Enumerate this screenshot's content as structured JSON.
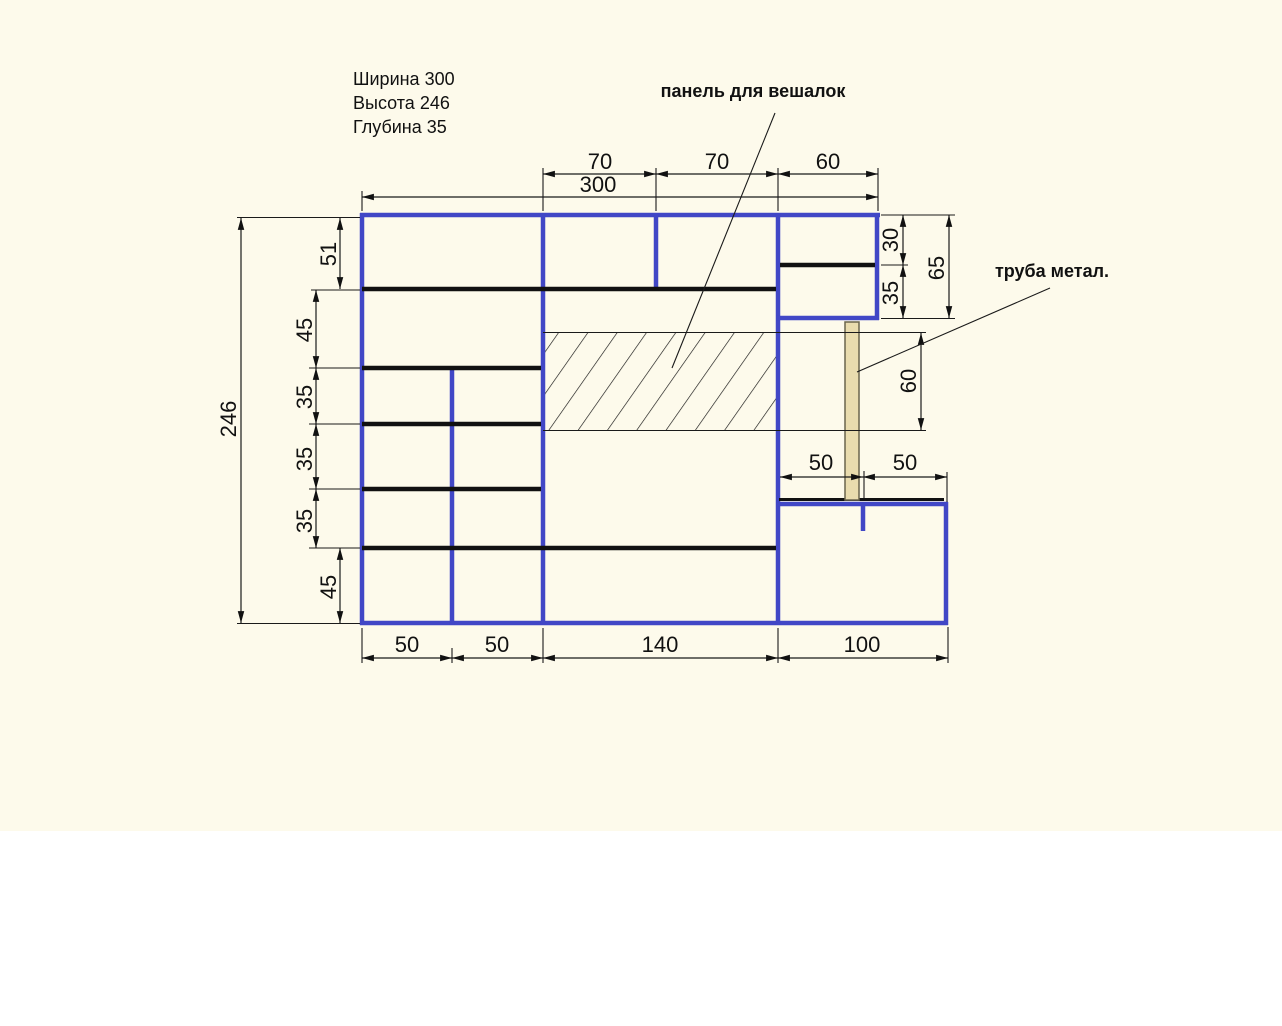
{
  "info_block": {
    "line1": "Ширина 300",
    "line2": "Высота 246",
    "line3": "Глубина 35"
  },
  "labels": {
    "panel": "панель для вешалок",
    "pipe": "труба метал."
  },
  "dims": {
    "top": {
      "d70a": "70",
      "d70b": "70",
      "d60": "60",
      "overall": "300"
    },
    "left": {
      "overall": "246",
      "r51": "51",
      "r45a": "45",
      "r35a": "35",
      "r35b": "35",
      "r35c": "35",
      "r45b": "45"
    },
    "right": {
      "d30": "30",
      "d35": "35",
      "d65": "65",
      "pipe60": "60"
    },
    "mid": {
      "d50a": "50",
      "d50b": "50"
    },
    "bottom": {
      "c50a": "50",
      "c50b": "50",
      "c140": "140",
      "c100": "100"
    }
  },
  "colors": {
    "background": "#fdfaeb",
    "paper_lower": "#ffffff",
    "structure_blue": "#4147c6",
    "line_black": "#1a1a1a",
    "pipe_fill": "#e9dcae",
    "pipe_border": "#6a654d"
  }
}
